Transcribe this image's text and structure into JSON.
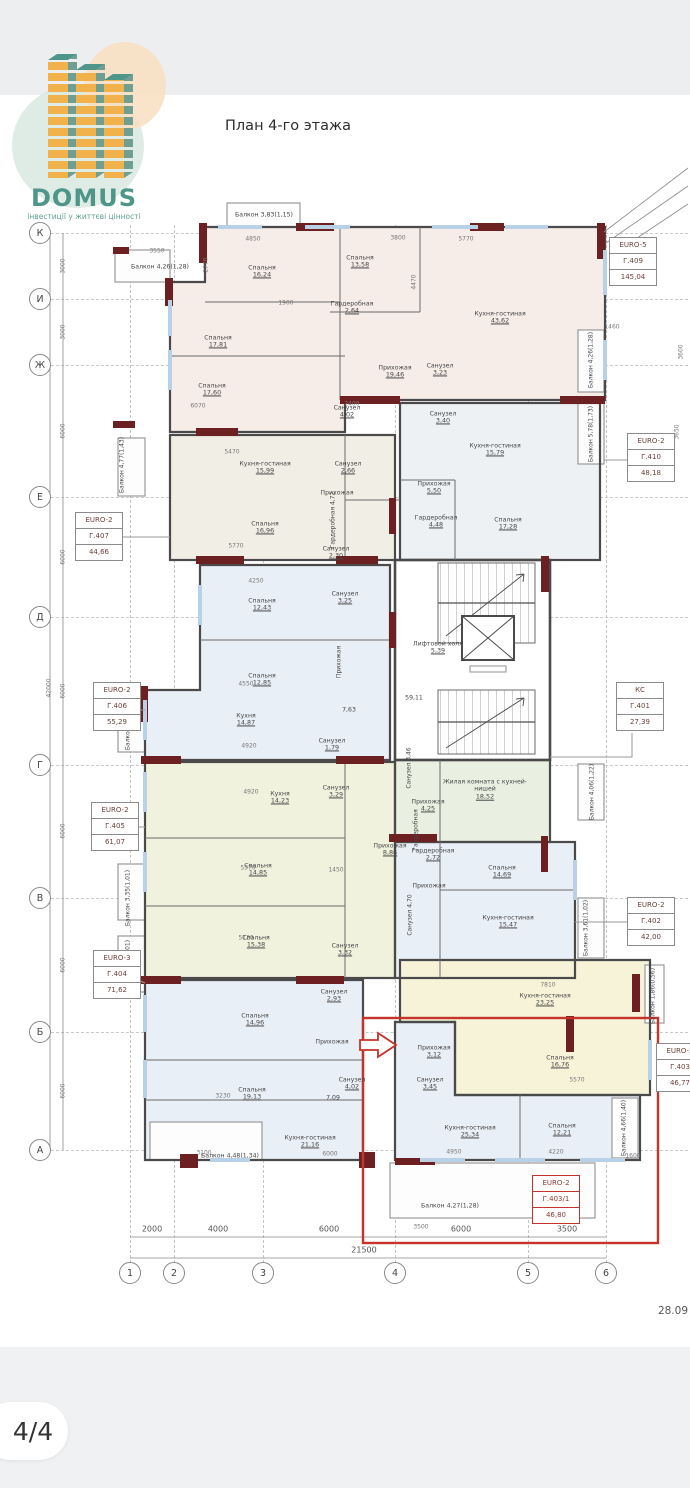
{
  "header": {
    "back_icon": "chevron-left",
    "share_icon": "share"
  },
  "logo": {
    "name": "DOMUS",
    "tagline": "інвестиції у життєві цінності"
  },
  "title": "План 4-го этажа",
  "footer": {
    "pagination": "4/4",
    "date": "28.09"
  },
  "palette": {
    "accent_red": "#c5332a",
    "brand_teal": "#4f968a",
    "brand_orange": "#f2b24b",
    "wall": "#4a4a4a",
    "wall_accent": "#6d2022",
    "window": "#b9d1e6",
    "fill_pink": "#f6ece8",
    "fill_beige": "#f1eee5",
    "fill_blue": "#e9eff6",
    "fill_yellow": "#f0f2dd",
    "fill_green": "#eaf0e1",
    "fill_yellow2": "#f6f3d8"
  },
  "plan": {
    "axes_rows": [
      {
        "l": "К",
        "y": 233
      },
      {
        "l": "И",
        "y": 299
      },
      {
        "l": "Ж",
        "y": 365
      },
      {
        "l": "Е",
        "y": 497
      },
      {
        "l": "Д",
        "y": 617
      },
      {
        "l": "Г",
        "y": 765
      },
      {
        "l": "В",
        "y": 898
      },
      {
        "l": "Б",
        "y": 1032
      },
      {
        "l": "А",
        "y": 1150
      }
    ],
    "axes_cols": [
      {
        "l": "1",
        "x": 130
      },
      {
        "l": "2",
        "x": 174
      },
      {
        "l": "3",
        "x": 263
      },
      {
        "l": "4",
        "x": 395
      },
      {
        "l": "5",
        "x": 528
      },
      {
        "l": "6",
        "x": 606
      }
    ],
    "dims_left": [
      {
        "t": "3000",
        "y": 266
      },
      {
        "t": "3000",
        "y": 332
      },
      {
        "t": "6000",
        "y": 431
      },
      {
        "t": "6000",
        "y": 557
      },
      {
        "t": "6000",
        "y": 691
      },
      {
        "t": "6000",
        "y": 831
      },
      {
        "t": "6000",
        "y": 965
      },
      {
        "t": "6000",
        "y": 1091
      }
    ],
    "dim_left_total": {
      "t": "42000",
      "y": 688
    },
    "dims_bottom": [
      {
        "t": "2000",
        "x": 152
      },
      {
        "t": "4000",
        "x": 218
      },
      {
        "t": "6000",
        "x": 329
      },
      {
        "t": "6000",
        "x": 461
      },
      {
        "t": "3500",
        "x": 567
      }
    ],
    "dim_bottom_total": {
      "t": "21500",
      "x": 364
    },
    "apartments": [
      {
        "t": "EURO-5",
        "id": "Г.409",
        "ar": "145,04",
        "x": 609,
        "y": 237
      },
      {
        "t": "EURO-2",
        "id": "Г.410",
        "ar": "48,18",
        "x": 627,
        "y": 433
      },
      {
        "t": "EURO-2",
        "id": "Г.407",
        "ar": "44,66",
        "x": 75,
        "y": 512
      },
      {
        "t": "EURO-2",
        "id": "Г.406",
        "ar": "55,29",
        "x": 93,
        "y": 682
      },
      {
        "t": "EURO-2",
        "id": "Г.405",
        "ar": "61,07",
        "x": 91,
        "y": 802
      },
      {
        "t": "EURO-3",
        "id": "Г.404",
        "ar": "71,62",
        "x": 93,
        "y": 950
      },
      {
        "t": "КС",
        "id": "Г.401",
        "ar": "27,39",
        "x": 616,
        "y": 682
      },
      {
        "t": "EURO-2",
        "id": "Г.402",
        "ar": "42,00",
        "x": 627,
        "y": 897
      },
      {
        "t": "EURO-2",
        "id": "Г.403",
        "ar": "46,77",
        "x": 656,
        "y": 1043
      },
      {
        "t": "EURO-2",
        "id": "Г.403/1",
        "ar": "46,80",
        "x": 532,
        "y": 1175,
        "red": true
      }
    ],
    "rooms": [
      {
        "n": "Балкон",
        "a": "4,26(1,28)",
        "x": 160,
        "y": 267,
        "i": 1
      },
      {
        "n": "Балкон",
        "a": "3,83(1,15)",
        "x": 264,
        "y": 215,
        "i": 1
      },
      {
        "n": "Спальня",
        "a": "16,24",
        "x": 262,
        "y": 272
      },
      {
        "n": "Спальня",
        "a": "13,58",
        "x": 360,
        "y": 262
      },
      {
        "n": "Кухня-гостиная",
        "a": "43,62",
        "x": 500,
        "y": 318
      },
      {
        "n": "Гардеробная",
        "a": "2,64",
        "x": 352,
        "y": 308
      },
      {
        "n": "Спальня",
        "a": "17,81",
        "x": 218,
        "y": 342
      },
      {
        "n": "Спальня",
        "a": "17,60",
        "x": 212,
        "y": 390
      },
      {
        "n": "Прихожая",
        "a": "19,46",
        "x": 395,
        "y": 372
      },
      {
        "n": "Санузел",
        "a": "3,23",
        "x": 440,
        "y": 370
      },
      {
        "n": "Санузел",
        "a": "3,40",
        "x": 443,
        "y": 418
      },
      {
        "n": "Санузел",
        "a": "4,02",
        "x": 347,
        "y": 412
      },
      {
        "n": "Балкон",
        "a": "4,26(1,28)",
        "x": 591,
        "y": 360,
        "v": 1
      },
      {
        "n": "Балкон",
        "a": "5,78(1,73)",
        "x": 591,
        "y": 434,
        "v": 1
      },
      {
        "n": "Кухня-гостиная",
        "a": "15,79",
        "x": 495,
        "y": 450
      },
      {
        "n": "Прихожая",
        "a": "5,50",
        "x": 434,
        "y": 488
      },
      {
        "n": "Гардеробная",
        "a": "4,48",
        "x": 436,
        "y": 522
      },
      {
        "n": "Спальня",
        "a": "17,28",
        "x": 508,
        "y": 524
      },
      {
        "n": "Кухня-гостиная",
        "a": "15,99",
        "x": 265,
        "y": 468
      },
      {
        "n": "Санузел",
        "a": "2,66",
        "x": 348,
        "y": 468
      },
      {
        "n": "Прихожая",
        "a": "",
        "x": 337,
        "y": 493
      },
      {
        "n": "Спальня",
        "a": "16,96",
        "x": 265,
        "y": 528
      },
      {
        "n": "Гардеробная",
        "a": "4,72",
        "x": 333,
        "y": 520,
        "v": 1
      },
      {
        "n": "Санузел",
        "a": "2,30",
        "x": 336,
        "y": 553
      },
      {
        "n": "Балкон",
        "a": "4,77(1,43)",
        "x": 122,
        "y": 465,
        "v": 1
      },
      {
        "n": "Спальня",
        "a": "12,43",
        "x": 262,
        "y": 605
      },
      {
        "n": "Санузел",
        "a": "3,25",
        "x": 345,
        "y": 598
      },
      {
        "n": "Спальня",
        "a": "12,85",
        "x": 262,
        "y": 680
      },
      {
        "n": "Прихожая",
        "a": "",
        "x": 339,
        "y": 662,
        "v": 1
      },
      {
        "n": "Кухня",
        "a": "14,87",
        "x": 246,
        "y": 720
      },
      {
        "n": "Санузел",
        "a": "1,79",
        "x": 332,
        "y": 745
      },
      {
        "n": "7,63",
        "a": "",
        "x": 349,
        "y": 710
      },
      {
        "n": "Балкон",
        "a": "3,23(0,97)",
        "x": 128,
        "y": 722,
        "v": 1
      },
      {
        "n": "Лифтовой холл",
        "a": "5,39",
        "x": 438,
        "y": 648
      },
      {
        "n": "59,11",
        "a": "",
        "x": 414,
        "y": 698
      },
      {
        "n": "Кухня",
        "a": "14,23",
        "x": 280,
        "y": 798
      },
      {
        "n": "Санузел",
        "a": "3,29",
        "x": 336,
        "y": 792
      },
      {
        "n": "Прихожая",
        "a": "8,86",
        "x": 390,
        "y": 850
      },
      {
        "n": "Спальня",
        "a": "14,85",
        "x": 258,
        "y": 870
      },
      {
        "n": "Спальня",
        "a": "15,38",
        "x": 256,
        "y": 942
      },
      {
        "n": "Санузел",
        "a": "3,32",
        "x": 345,
        "y": 950
      },
      {
        "n": "Балкон",
        "a": "3,35(1,01)",
        "x": 128,
        "y": 898,
        "v": 1
      },
      {
        "n": "Балкон",
        "a": "3,35(1,01)",
        "x": 128,
        "y": 968,
        "v": 1
      },
      {
        "n": "Жилая комната с кухней-нишей",
        "a": "18,52",
        "x": 485,
        "y": 790,
        "w": 92
      },
      {
        "n": "Прихожая",
        "a": "4,25",
        "x": 428,
        "y": 806
      },
      {
        "n": "Гардеробная",
        "a": "",
        "x": 416,
        "y": 830,
        "v": 1
      },
      {
        "n": "Санузел",
        "a": "3,46",
        "x": 409,
        "y": 768,
        "v": 1
      },
      {
        "n": "Балкон",
        "a": "4,06(1,22)",
        "x": 592,
        "y": 792,
        "v": 1
      },
      {
        "n": "Гардеробная",
        "a": "2,72",
        "x": 433,
        "y": 855
      },
      {
        "n": "Спальня",
        "a": "14,69",
        "x": 502,
        "y": 872
      },
      {
        "n": "Прихожая",
        "a": "",
        "x": 429,
        "y": 886
      },
      {
        "n": "Санузел",
        "a": "4,70",
        "x": 410,
        "y": 915,
        "v": 1
      },
      {
        "n": "Кухня-гостиная",
        "a": "15,47",
        "x": 508,
        "y": 922
      },
      {
        "n": "Балкон",
        "a": "3,61(1,02)",
        "x": 586,
        "y": 928,
        "v": 1
      },
      {
        "n": "Кухня-гостиная",
        "a": "23,25",
        "x": 545,
        "y": 1000
      },
      {
        "n": "Спальня",
        "a": "16,76",
        "x": 560,
        "y": 1062
      },
      {
        "n": "Балкон",
        "a": "1,86(0,56)",
        "x": 653,
        "y": 996,
        "v": 1
      },
      {
        "n": "Спальня",
        "a": "14,96",
        "x": 255,
        "y": 1020
      },
      {
        "n": "Санузел",
        "a": "2,93",
        "x": 334,
        "y": 996
      },
      {
        "n": "Прихожая",
        "a": "",
        "x": 332,
        "y": 1042
      },
      {
        "n": "Спальня",
        "a": "19,13",
        "x": 252,
        "y": 1094
      },
      {
        "n": "Санузел",
        "a": "4,02",
        "x": 352,
        "y": 1084
      },
      {
        "n": "7,09",
        "a": "",
        "x": 333,
        "y": 1098
      },
      {
        "n": "Кухня-гостиная",
        "a": "21,16",
        "x": 310,
        "y": 1142
      },
      {
        "n": "Балкон",
        "a": "4,48(1,34)",
        "x": 230,
        "y": 1156,
        "i": 1
      },
      {
        "n": "Прихожая",
        "a": "3,12",
        "x": 434,
        "y": 1052
      },
      {
        "n": "Санузел",
        "a": "3,45",
        "x": 430,
        "y": 1084
      },
      {
        "n": "Кухня-гостиная",
        "a": "25,34",
        "x": 470,
        "y": 1132
      },
      {
        "n": "Спальня",
        "a": "12,21",
        "x": 562,
        "y": 1130
      },
      {
        "n": "Балкон",
        "a": "4,66(1,40)",
        "x": 624,
        "y": 1128,
        "v": 1
      },
      {
        "n": "Балкон",
        "a": "4,27(1,28)",
        "x": 450,
        "y": 1206,
        "i": 1
      }
    ],
    "dims_small": [
      {
        "t": "3550",
        "x": 157,
        "y": 251
      },
      {
        "t": "4850",
        "x": 253,
        "y": 239
      },
      {
        "t": "3800",
        "x": 398,
        "y": 238
      },
      {
        "t": "5770",
        "x": 466,
        "y": 239
      },
      {
        "t": "2770",
        "x": 206,
        "y": 265,
        "r": 1
      },
      {
        "t": "4470",
        "x": 414,
        "y": 282,
        "r": 1
      },
      {
        "t": "1460",
        "x": 612,
        "y": 327
      },
      {
        "t": "1900",
        "x": 286,
        "y": 303
      },
      {
        "t": "6070",
        "x": 198,
        "y": 406
      },
      {
        "t": "2400",
        "x": 352,
        "y": 404
      },
      {
        "t": "5470",
        "x": 232,
        "y": 452
      },
      {
        "t": "5770",
        "x": 236,
        "y": 546
      },
      {
        "t": "4250",
        "x": 256,
        "y": 581
      },
      {
        "t": "4550",
        "x": 246,
        "y": 684
      },
      {
        "t": "4920",
        "x": 249,
        "y": 746
      },
      {
        "t": "4920",
        "x": 251,
        "y": 792
      },
      {
        "t": "5370",
        "x": 248,
        "y": 868
      },
      {
        "t": "1450",
        "x": 336,
        "y": 870
      },
      {
        "t": "5120",
        "x": 246,
        "y": 938
      },
      {
        "t": "3230",
        "x": 223,
        "y": 1096
      },
      {
        "t": "3100",
        "x": 204,
        "y": 1153
      },
      {
        "t": "6000",
        "x": 330,
        "y": 1154
      },
      {
        "t": "4950",
        "x": 454,
        "y": 1152
      },
      {
        "t": "4220",
        "x": 556,
        "y": 1152
      },
      {
        "t": "1600",
        "x": 633,
        "y": 1156
      },
      {
        "t": "3500",
        "x": 421,
        "y": 1227
      },
      {
        "t": "7810",
        "x": 548,
        "y": 985
      },
      {
        "t": "5570",
        "x": 577,
        "y": 1080
      },
      {
        "t": "3600",
        "x": 681,
        "y": 352,
        "r": 1
      },
      {
        "t": "3650",
        "x": 677,
        "y": 432,
        "r": 1
      }
    ]
  }
}
